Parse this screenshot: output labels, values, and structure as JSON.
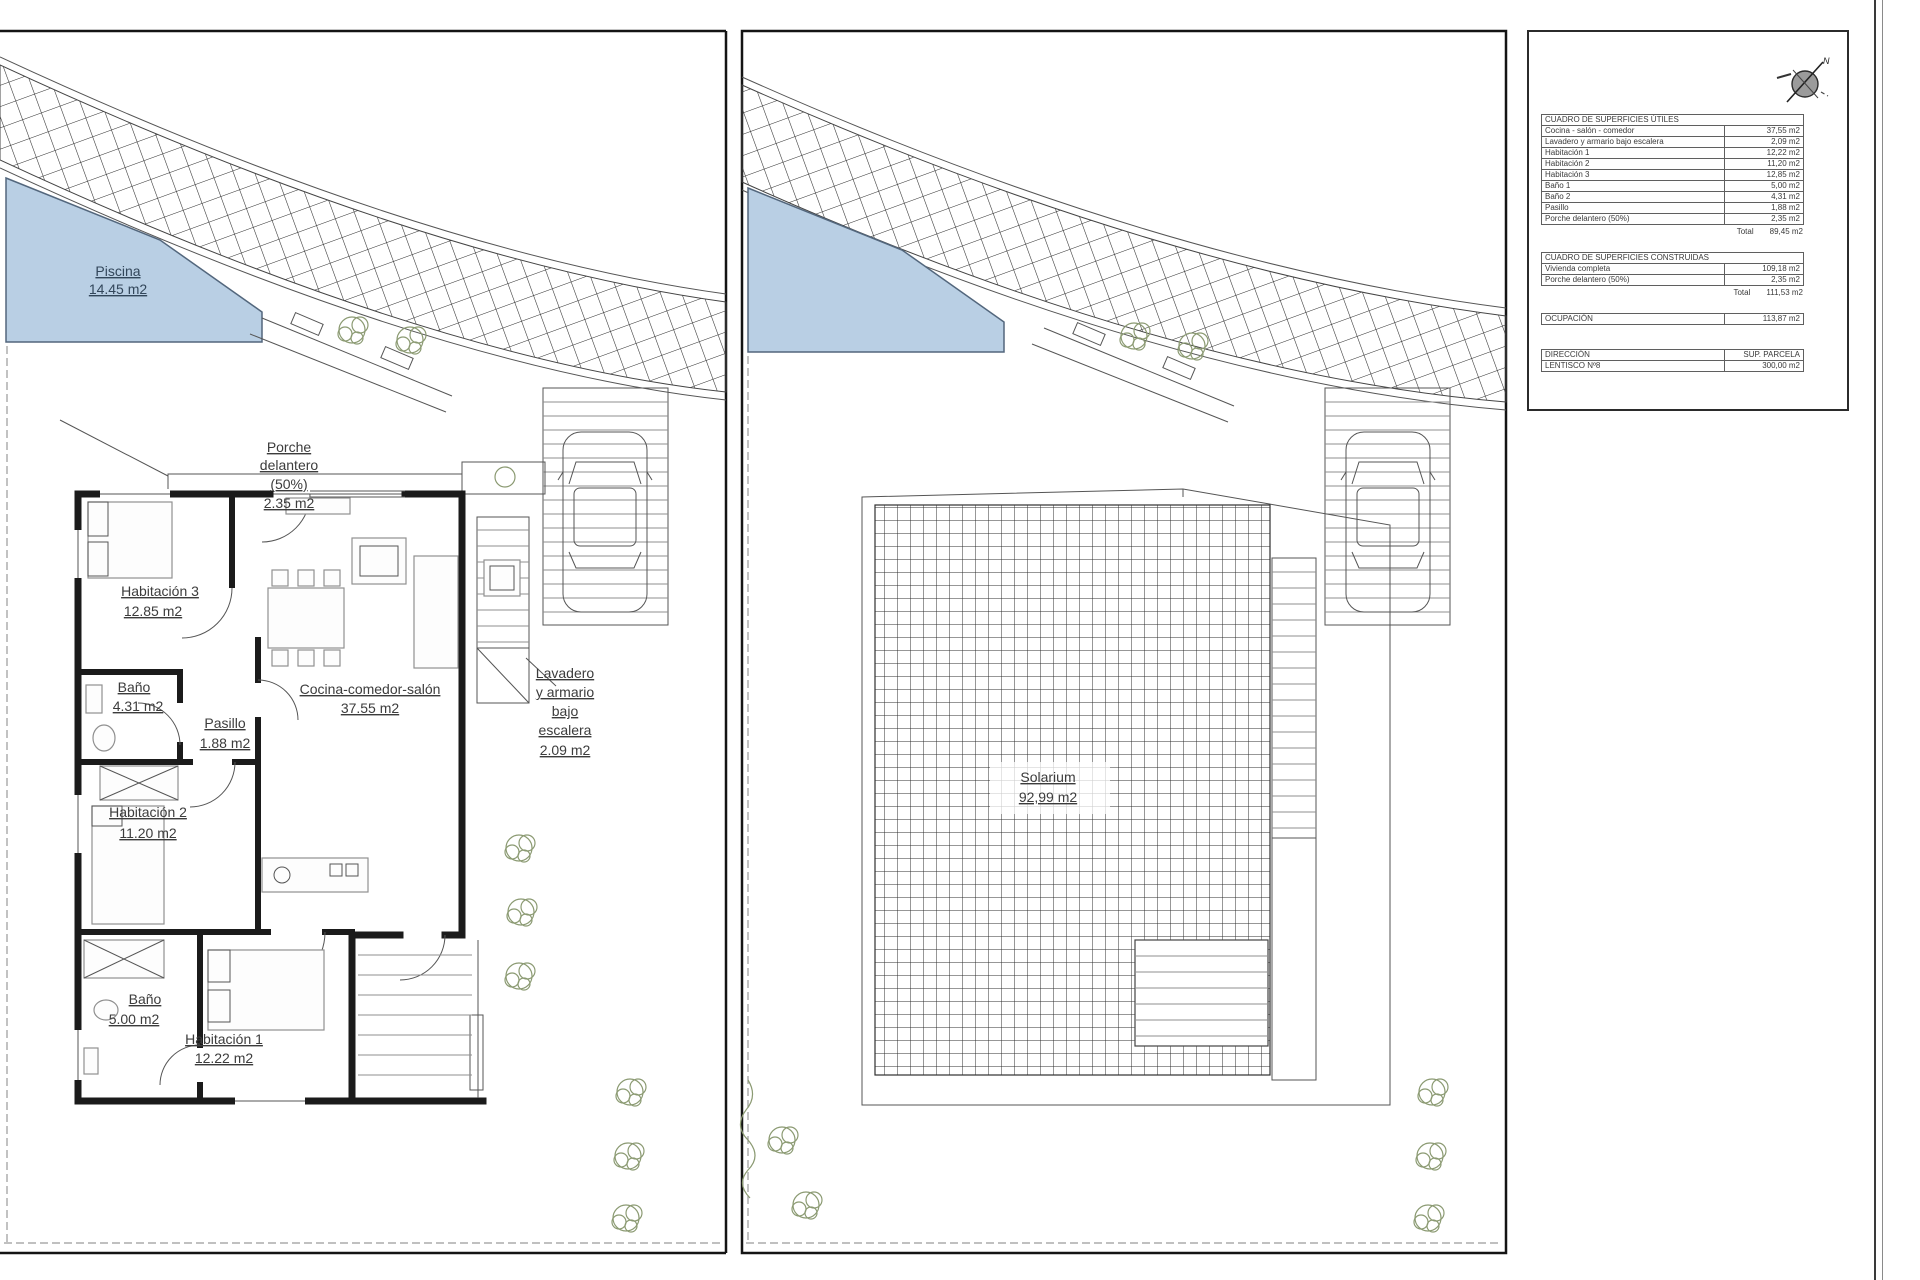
{
  "left_plan": {
    "pool": {
      "name": "Piscina",
      "area": "14.45 m2"
    },
    "rooms": {
      "porche": {
        "line1": "Porche",
        "line2": "delantero",
        "line3": "(50%)",
        "area": "2.35 m2"
      },
      "hab3": {
        "name": "Habitación 3",
        "area": "12.85 m2"
      },
      "bano2": {
        "name": "Baño",
        "area": "4.31 m2"
      },
      "pasillo": {
        "name": "Pasillo",
        "area": "1.88 m2"
      },
      "cocina": {
        "name": "Cocina-comedor-salón",
        "area": "37.55 m2"
      },
      "lavadero": {
        "line1": "Lavadero",
        "line2": "y armario",
        "line3": "bajo",
        "line4": "escalera",
        "area": "2.09 m2"
      },
      "hab2": {
        "name": "Habitación 2",
        "area": "11.20 m2"
      },
      "bano1": {
        "name": "Baño",
        "area": "5.00 m2"
      },
      "hab1": {
        "name": "Habitación 1",
        "area": "12.22 m2"
      }
    }
  },
  "right_plan": {
    "solarium": {
      "name": "Solarium",
      "area": "92,99 m2"
    }
  },
  "summary": {
    "compass_label": "N",
    "utiles": {
      "title": "CUADRO DE SUPERFICIES ÚTILES",
      "rows": [
        {
          "label": "Cocina - salón - comedor",
          "value": "37,55 m2"
        },
        {
          "label": "Lavadero y armario bajo escalera",
          "value": "2,09 m2"
        },
        {
          "label": "Habitación 1",
          "value": "12,22 m2"
        },
        {
          "label": "Habitación 2",
          "value": "11,20 m2"
        },
        {
          "label": "Habitación 3",
          "value": "12,85 m2"
        },
        {
          "label": "Baño 1",
          "value": "5,00 m2"
        },
        {
          "label": "Baño 2",
          "value": "4,31 m2"
        },
        {
          "label": "Pasillo",
          "value": "1,88 m2"
        },
        {
          "label": "Porche delantero (50%)",
          "value": "2,35 m2"
        }
      ],
      "total_label": "Total",
      "total": "89,45 m2"
    },
    "construidas": {
      "title": "CUADRO DE SUPERFICIES CONSTRUIDAS",
      "rows": [
        {
          "label": "Vivienda completa",
          "value": "109,18 m2"
        },
        {
          "label": "Porche delantero (50%)",
          "value": "2,35 m2"
        }
      ],
      "total_label": "Total",
      "total": "111,53 m2"
    },
    "ocupacion": {
      "label": "OCUPACIÓN",
      "value": "113,87 m2"
    },
    "parcela": {
      "header_left": "DIRECCIÓN",
      "header_right": "SUP. PARCELA",
      "row_left": "LENTISCO Nº8",
      "row_right": "300,00 m2"
    }
  }
}
